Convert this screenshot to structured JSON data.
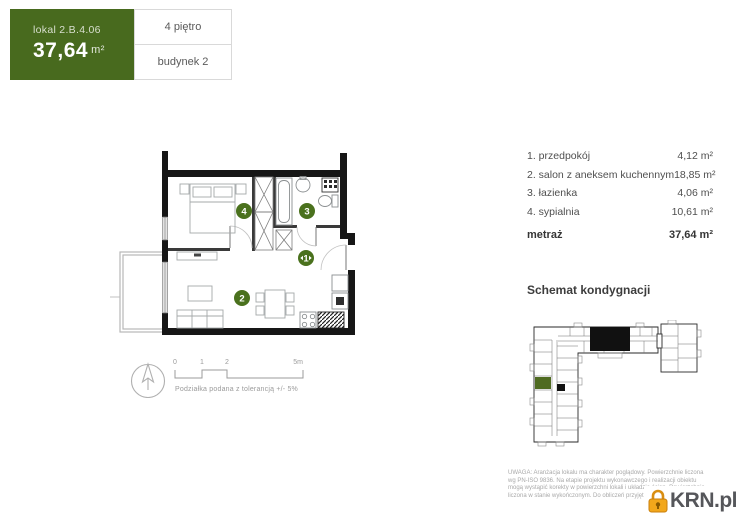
{
  "header": {
    "unit_label": "lokal 2.B.4.06",
    "area_value": "37,64",
    "area_unit": "m²",
    "floor_label": "4 piętro",
    "building_label": "budynek 2"
  },
  "room_list": {
    "items": [
      {
        "name": "1. przedpokój",
        "area": "4,12 m²"
      },
      {
        "name": "2. salon z aneksem kuchennym",
        "area": "18,85 m²"
      },
      {
        "name": "3. łazienka",
        "area": "4,06 m²"
      },
      {
        "name": "4. sypialnia",
        "area": "10,61 m²"
      }
    ],
    "total_label": "metraż",
    "total_area": "37,64 m²"
  },
  "floor_plan": {
    "markers": {
      "hall": "1",
      "living": "2",
      "bathroom": "3",
      "bedroom": "4"
    }
  },
  "scale_bar": {
    "ticks": [
      "0",
      "1",
      "2",
      "5m"
    ],
    "note": "Podziałka podana z tolerancją +/- 5%"
  },
  "schematic": {
    "title": "Schemat kondygnacji"
  },
  "disclaimer": {
    "line1": "UWAGA: Aranżacja lokalu ma charakter poglądowy. Powierzchnie liczona",
    "line2": "wg PN-ISO 9836. Na etapie projektu wykonawczego i realizacji obiektu",
    "line3": "mogą wystąpić korekty w powierzchni lokali i układzie ścian. Powierzchnia",
    "line4": "liczona w stanie wykończonym. Do obliczeń przyjęto powierzchnię."
  },
  "logo": {
    "text": "KRN.pl"
  },
  "colors": {
    "brand_green": "#486a1e",
    "marker_green": "#4a711d",
    "schematic_green": "#4f6b21",
    "logo_orange": "#f2a71b",
    "wall_black": "#161616"
  }
}
